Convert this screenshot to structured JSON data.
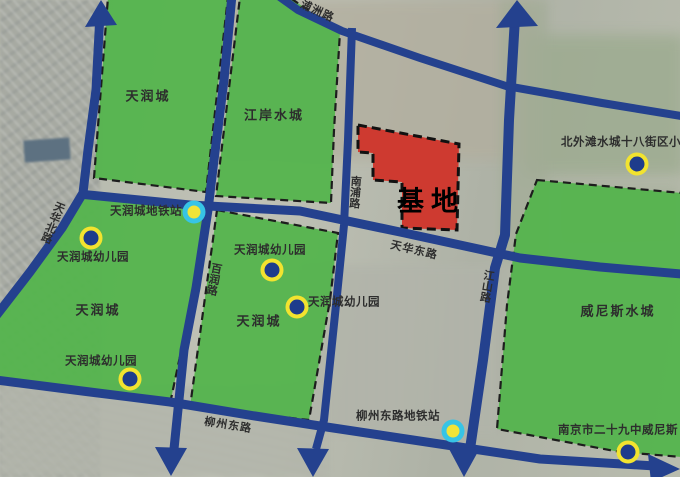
{
  "map_type": "urban-planning-map",
  "colors": {
    "road": "#24418e",
    "region_green": "#55b44e",
    "site_red": "#ce3a30",
    "school_marker_fill": "#1e3c8c",
    "school_marker_ring": "#f2e32f",
    "metro_marker_fill": "#f2e438",
    "metro_marker_ring": "#37c4e6",
    "label_text": "#2d2d2d"
  },
  "regions": [
    {
      "name": "tianrun-city-northwest",
      "label": "天润城"
    },
    {
      "name": "jiangan-water-city",
      "label": "江岸水城"
    },
    {
      "name": "tianrun-city-west",
      "label": "天润城"
    },
    {
      "name": "tianrun-city-central",
      "label": "天润城"
    },
    {
      "name": "venice-water-city",
      "label": "威尼斯水城"
    }
  ],
  "site": {
    "label": "基地"
  },
  "roads": [
    {
      "name": "puzhou-road",
      "label": "浦洲路"
    },
    {
      "name": "tianhua-north-road",
      "label": "天华北路"
    },
    {
      "name": "bairun-road",
      "label": "百润路"
    },
    {
      "name": "nanpu-road",
      "label": "南浦路"
    },
    {
      "name": "tianhua-east-road",
      "label": "天华东路"
    },
    {
      "name": "jiangshan-road",
      "label": "江山路"
    },
    {
      "name": "liuzhou-east-road",
      "label": "柳州东路"
    }
  ],
  "metro_stations": [
    {
      "label": "天润城地铁站"
    },
    {
      "label": "柳州东路地铁站"
    }
  ],
  "schools": [
    {
      "label": "天润城幼儿园"
    },
    {
      "label": "天润城幼儿园"
    },
    {
      "label": "天润城幼儿园"
    },
    {
      "label": "天润城幼儿园"
    },
    {
      "label": "北外滩水城十八街区小"
    },
    {
      "label": "南京市二十九中威尼斯"
    }
  ]
}
